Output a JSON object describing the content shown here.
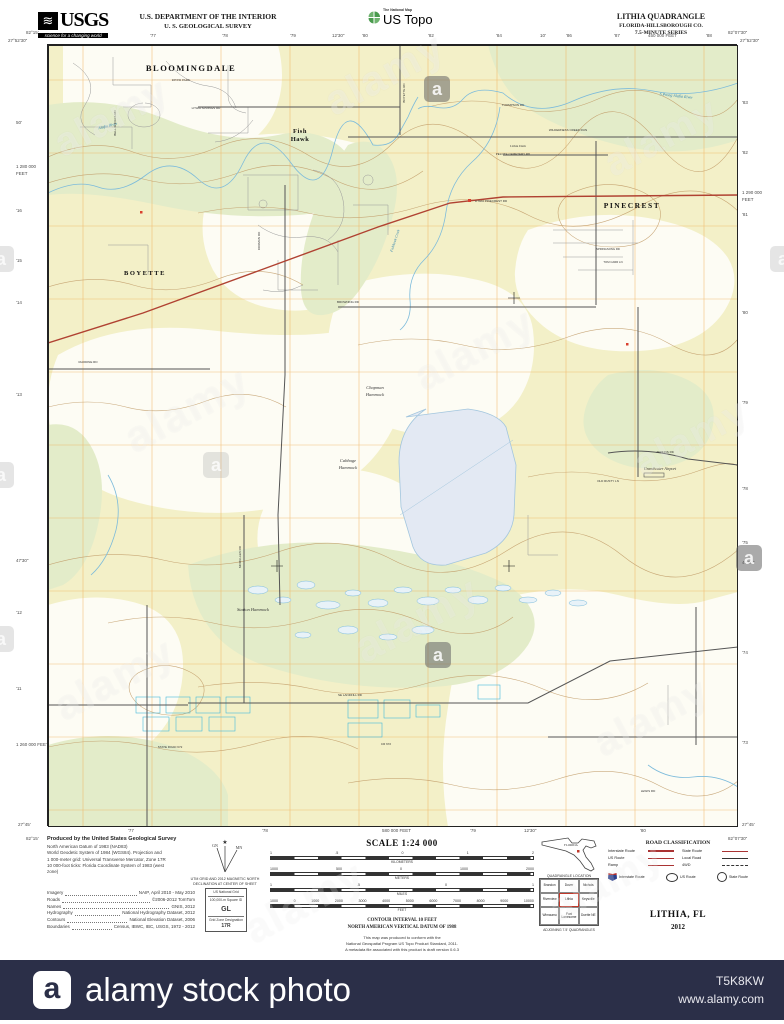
{
  "header": {
    "usgs_glyph": "≋",
    "usgs_word": "USGS",
    "usgs_tagline": "science for a changing world",
    "dept_line1": "U.S. DEPARTMENT OF THE INTERIOR",
    "dept_line2": "U. S. GEOLOGICAL SURVEY",
    "ustopo_small": "The National Map",
    "ustopo_big": "US Topo",
    "quad_title": "LITHIA QUADRANGLE",
    "quad_sub1": "FLORIDA-HILLSBOROUGH CO.",
    "quad_sub2": "7.5-MINUTE SERIES"
  },
  "collar": {
    "corners": [
      {
        "t": "82°15'",
        "x": 26,
        "y": 30
      },
      {
        "t": "27°52'30\"",
        "x": 8,
        "y": 38
      },
      {
        "t": "82°07'30\"",
        "x": 728,
        "y": 30
      },
      {
        "t": "27°52'30\"",
        "x": 740,
        "y": 38
      },
      {
        "t": "82°15'",
        "x": 26,
        "y": 836
      },
      {
        "t": "27°45'",
        "x": 18,
        "y": 822
      },
      {
        "t": "82°07'30\"",
        "x": 728,
        "y": 836
      },
      {
        "t": "27°45'",
        "x": 742,
        "y": 822
      }
    ],
    "top": [
      {
        "t": "'77",
        "x": 150
      },
      {
        "t": "'78",
        "x": 222
      },
      {
        "t": "'79",
        "x": 290
      },
      {
        "t": "12'30\"",
        "x": 332
      },
      {
        "t": "'80",
        "x": 362
      },
      {
        "t": "'82",
        "x": 428
      },
      {
        "t": "'84",
        "x": 496
      },
      {
        "t": "10'",
        "x": 540
      },
      {
        "t": "'86",
        "x": 566
      },
      {
        "t": "'87",
        "x": 614
      },
      {
        "t": "450 000 FEET",
        "x": 648
      },
      {
        "t": "'88",
        "x": 706
      }
    ],
    "bottom": [
      {
        "t": "'77",
        "x": 128
      },
      {
        "t": "'78",
        "x": 262
      },
      {
        "t": "580 000 FEET",
        "x": 382
      },
      {
        "t": "'79",
        "x": 470
      },
      {
        "t": "12'30\"",
        "x": 524
      },
      {
        "t": "'80",
        "x": 640
      }
    ],
    "left": [
      {
        "t": "50'",
        "y": 120
      },
      {
        "t": "1 280 000",
        "y": 164
      },
      {
        "t": "FEET",
        "y": 171
      },
      {
        "t": "'16",
        "y": 208
      },
      {
        "t": "'15",
        "y": 258
      },
      {
        "t": "'14",
        "y": 300
      },
      {
        "t": "'13",
        "y": 392
      },
      {
        "t": "47'30\"",
        "y": 558
      },
      {
        "t": "'12",
        "y": 610
      },
      {
        "t": "'11",
        "y": 686
      },
      {
        "t": "1 260 000 FEET",
        "y": 742
      }
    ],
    "right": [
      {
        "t": "'83",
        "y": 100
      },
      {
        "t": "'82",
        "y": 150
      },
      {
        "t": "1 290 000",
        "y": 190
      },
      {
        "t": "FEET",
        "y": 197
      },
      {
        "t": "'81",
        "y": 212
      },
      {
        "t": "'80",
        "y": 310
      },
      {
        "t": "'79",
        "y": 400
      },
      {
        "t": "'78",
        "y": 486
      },
      {
        "t": "'75",
        "y": 540
      },
      {
        "t": "47'30\"",
        "y": 560
      },
      {
        "t": "'74",
        "y": 650
      },
      {
        "t": "'73",
        "y": 740
      }
    ]
  },
  "map_labels": [
    {
      "t": "BLOOMINGDALE",
      "x": 143,
      "y": 26,
      "cls": "place",
      "fs": 8.5
    },
    {
      "t": "RIVER PARK",
      "x": 133,
      "y": 36,
      "cls": "small",
      "fs": 3.2
    },
    {
      "t": "BOYETTE",
      "x": 97,
      "y": 230,
      "cls": "place",
      "fs": 6.5
    },
    {
      "t": "Fish",
      "x": 252,
      "y": 88,
      "cls": "place2",
      "fs": 6.5
    },
    {
      "t": "Hawk",
      "x": 252,
      "y": 96,
      "cls": "place2",
      "fs": 6.5
    },
    {
      "t": "PINECREST",
      "x": 584,
      "y": 163,
      "cls": "place",
      "fs": 7.5
    },
    {
      "t": "Chapman",
      "x": 327,
      "y": 344,
      "cls": "ital",
      "fs": 4.5
    },
    {
      "t": "Hammock",
      "x": 327,
      "y": 351,
      "cls": "ital",
      "fs": 4.5
    },
    {
      "t": "Cabbage",
      "x": 300,
      "y": 417,
      "cls": "ital",
      "fs": 4.5
    },
    {
      "t": "Hammock",
      "x": 300,
      "y": 424,
      "cls": "ital",
      "fs": 4.5
    },
    {
      "t": "Station Hammock",
      "x": 205,
      "y": 566,
      "cls": "ital",
      "fs": 4.5
    },
    {
      "t": "Grandwater Airport",
      "x": 612,
      "y": 425,
      "cls": "ital",
      "fs": 4
    },
    {
      "t": "Lithia Dam",
      "x": 470,
      "y": 102,
      "cls": "small",
      "fs": 3.4
    },
    {
      "t": "Alafia River",
      "x": 60,
      "y": 82,
      "cls": "water",
      "fs": 4,
      "r": -14
    },
    {
      "t": "S Prong Alafia River",
      "x": 628,
      "y": 52,
      "cls": "water",
      "fs": 4,
      "r": 6
    },
    {
      "t": "Fishhawk Creek",
      "x": 348,
      "y": 196,
      "cls": "water",
      "fs": 3.6,
      "r": -72
    },
    {
      "t": "LITHIA SPRINGS RD",
      "x": 158,
      "y": 64,
      "cls": "road",
      "fs": 3
    },
    {
      "t": "THOMPSON RD",
      "x": 465,
      "y": 61,
      "cls": "road",
      "fs": 3
    },
    {
      "t": "WILDERNESS CREEK RUN",
      "x": 520,
      "y": 86,
      "cls": "road",
      "fs": 3
    },
    {
      "t": "PELOTE CEMETERY RD",
      "x": 465,
      "y": 110,
      "cls": "road",
      "fs": 3
    },
    {
      "t": "LITHIA PINECREST RD",
      "x": 443,
      "y": 157,
      "cls": "road",
      "fs": 3
    },
    {
      "t": "BROWNING RD",
      "x": 300,
      "y": 258,
      "cls": "road",
      "fs": 3
    },
    {
      "t": "RHODINE RD",
      "x": 40,
      "y": 318,
      "cls": "road",
      "fs": 3
    },
    {
      "t": "DORMAN RD",
      "x": 212,
      "y": 196,
      "cls": "road",
      "fs": 3,
      "r": -90
    },
    {
      "t": "BELL SHOALS RD",
      "x": 68,
      "y": 78,
      "cls": "road",
      "fs": 3,
      "r": -90
    },
    {
      "t": "BOYETTE RD",
      "x": 357,
      "y": 48,
      "cls": "road",
      "fs": 3,
      "r": -90
    },
    {
      "t": "MCMULLEN RD",
      "x": 193,
      "y": 512,
      "cls": "road",
      "fs": 3,
      "r": -90
    },
    {
      "t": "SE LANDFILL RD",
      "x": 302,
      "y": 651,
      "cls": "road",
      "fs": 3
    },
    {
      "t": "STATE ROAD 672",
      "x": 122,
      "y": 703,
      "cls": "road",
      "fs": 3
    },
    {
      "t": "CR 672",
      "x": 338,
      "y": 700,
      "cls": "road",
      "fs": 3
    },
    {
      "t": "JERKINS RD",
      "x": 617,
      "y": 408,
      "cls": "road",
      "fs": 3
    },
    {
      "t": "OLD RUSTY LN",
      "x": 560,
      "y": 437,
      "cls": "road",
      "fs": 3
    },
    {
      "t": "LEWIS RD",
      "x": 600,
      "y": 747,
      "cls": "road",
      "fs": 3
    },
    {
      "t": "SPRINGSONG RD",
      "x": 560,
      "y": 205,
      "cls": "road",
      "fs": 2.8
    },
    {
      "t": "TOM CARR LN",
      "x": 565,
      "y": 218,
      "cls": "road",
      "fs": 2.8
    }
  ],
  "footer": {
    "produced_lines": [
      "Produced by the United States Geological Survey",
      "North American Datum of 1983 (NAD83)",
      "World Geodetic System of 1984 (WGS84).  Projection and",
      "1 000-meter grid:  Universal Transverse Mercator, Zone 17R",
      "10 000-foot ticks:  Florida Coordinate System of 1983 (west",
      "zone)"
    ],
    "credits": [
      {
        "label": "Imagery",
        "value": "NAIP, April 2010 - May 2010"
      },
      {
        "label": "Roads",
        "value": "©2006-2012 TomTom"
      },
      {
        "label": "Names",
        "value": "GNIS, 2012"
      },
      {
        "label": "Hydrography",
        "value": "National Hydrography Dataset, 2012"
      },
      {
        "label": "Contours",
        "value": "National Elevation Dataset, 2006"
      },
      {
        "label": "Boundaries",
        "value": "Census, IBWC, IBC, USGS, 1972 - 2012"
      }
    ],
    "decl_cap1": "UTM GRID AND 2012 MAGNETIC NORTH",
    "decl_cap2": "DECLINATION AT CENTER OF SHEET",
    "usng": {
      "title": "US National Grid",
      "sub": "100,000-m Square ID",
      "square": "GL",
      "zone_label": "Grid Zone Designation",
      "zone": "17R"
    },
    "scale_title": "SCALE 1:24 000",
    "scale_bars": [
      {
        "unit": "KILOMETERS",
        "nums": [
          "1",
          ".5",
          "0",
          "1",
          "2"
        ]
      },
      {
        "unit": "METERS",
        "nums": [
          "1000",
          "500",
          "0",
          "1000",
          "2000"
        ]
      },
      {
        "unit": "MILES",
        "nums": [
          "1",
          ".5",
          "0",
          "1"
        ]
      },
      {
        "unit": "FEET",
        "nums": [
          "1000",
          "0",
          "1000",
          "2000",
          "3000",
          "4000",
          "5000",
          "6000",
          "7000",
          "8000",
          "9000",
          "10000"
        ]
      }
    ],
    "contour_line1": "CONTOUR INTERVAL 10 FEET",
    "contour_line2": "NORTH AMERICAN VERTICAL DATUM OF 1988",
    "note_lines": [
      "This map was produced to conform with the",
      "National Geospatial Program US Topo Product Standard, 2011.",
      "A metadata file associated with this product is draft version 0.6.3"
    ],
    "state_label": "FLORIDA",
    "quad_location_caption": "QUADRANGLE LOCATION",
    "adjoining": {
      "grid": [
        [
          "Brandon",
          "Dover",
          "Nichols"
        ],
        [
          "Riverview",
          "Lithia",
          "Keysville"
        ],
        [
          "Wimauma",
          "Fort Lonesome",
          "Duette NE"
        ]
      ],
      "caption": "ADJOINING 7.5' QUADRANGLES"
    },
    "road_class": {
      "title": "ROAD CLASSIFICATION",
      "left": [
        "Interstate Route",
        "US Route",
        "Ramp"
      ],
      "right": [
        "State Route",
        "Local Road",
        "4WD"
      ],
      "shields": [
        "Interstate Route",
        "US Route",
        "State Route"
      ]
    },
    "map_name": "LITHIA, FL",
    "map_year": "2012"
  },
  "watermarks": {
    "text": "alamy",
    "badge": "a",
    "items": [
      {
        "x": 50,
        "y": 95,
        "s": 40,
        "o": 0.5
      },
      {
        "x": 320,
        "y": 50,
        "s": 42,
        "o": 0.5
      },
      {
        "x": 600,
        "y": 115,
        "s": 40,
        "o": 0.45
      },
      {
        "x": 120,
        "y": 385,
        "s": 44,
        "o": 0.4
      },
      {
        "x": 410,
        "y": 325,
        "s": 42,
        "o": 0.4
      },
      {
        "x": 630,
        "y": 415,
        "s": 40,
        "o": 0.45
      },
      {
        "x": 50,
        "y": 655,
        "s": 42,
        "o": 0.45
      },
      {
        "x": 350,
        "y": 595,
        "s": 44,
        "o": 0.4
      },
      {
        "x": 590,
        "y": 695,
        "s": 40,
        "o": 0.45
      },
      {
        "x": 240,
        "y": 878,
        "s": 42,
        "o": 0.35
      },
      {
        "x": 545,
        "y": 860,
        "s": 40,
        "o": 0.35
      }
    ],
    "badges": [
      {
        "x": 424,
        "y": 76,
        "k": "dark"
      },
      {
        "x": 203,
        "y": 452,
        "k": "light"
      },
      {
        "x": 425,
        "y": 642,
        "k": "dark"
      },
      {
        "x": 736,
        "y": 545,
        "k": "dark"
      },
      {
        "x": -12,
        "y": 246,
        "k": "light"
      },
      {
        "x": -12,
        "y": 462,
        "k": "light"
      },
      {
        "x": -12,
        "y": 626,
        "k": "light"
      },
      {
        "x": 770,
        "y": 246,
        "k": "light"
      }
    ]
  },
  "bottom_bar": {
    "logo": "a",
    "title": "alamy stock photo",
    "image_id": "T5K8KW",
    "url": "www.alamy.com"
  },
  "colors": {
    "bar_bg": "#2b2f48",
    "map_land": "#f3f0c8",
    "map_green": "#e3ecc9",
    "water_line": "#7cbbdb",
    "contour": "#c09a66",
    "grid_orange": "#f0ad57",
    "road_red": "#b04232",
    "building_red": "#d9402f"
  }
}
